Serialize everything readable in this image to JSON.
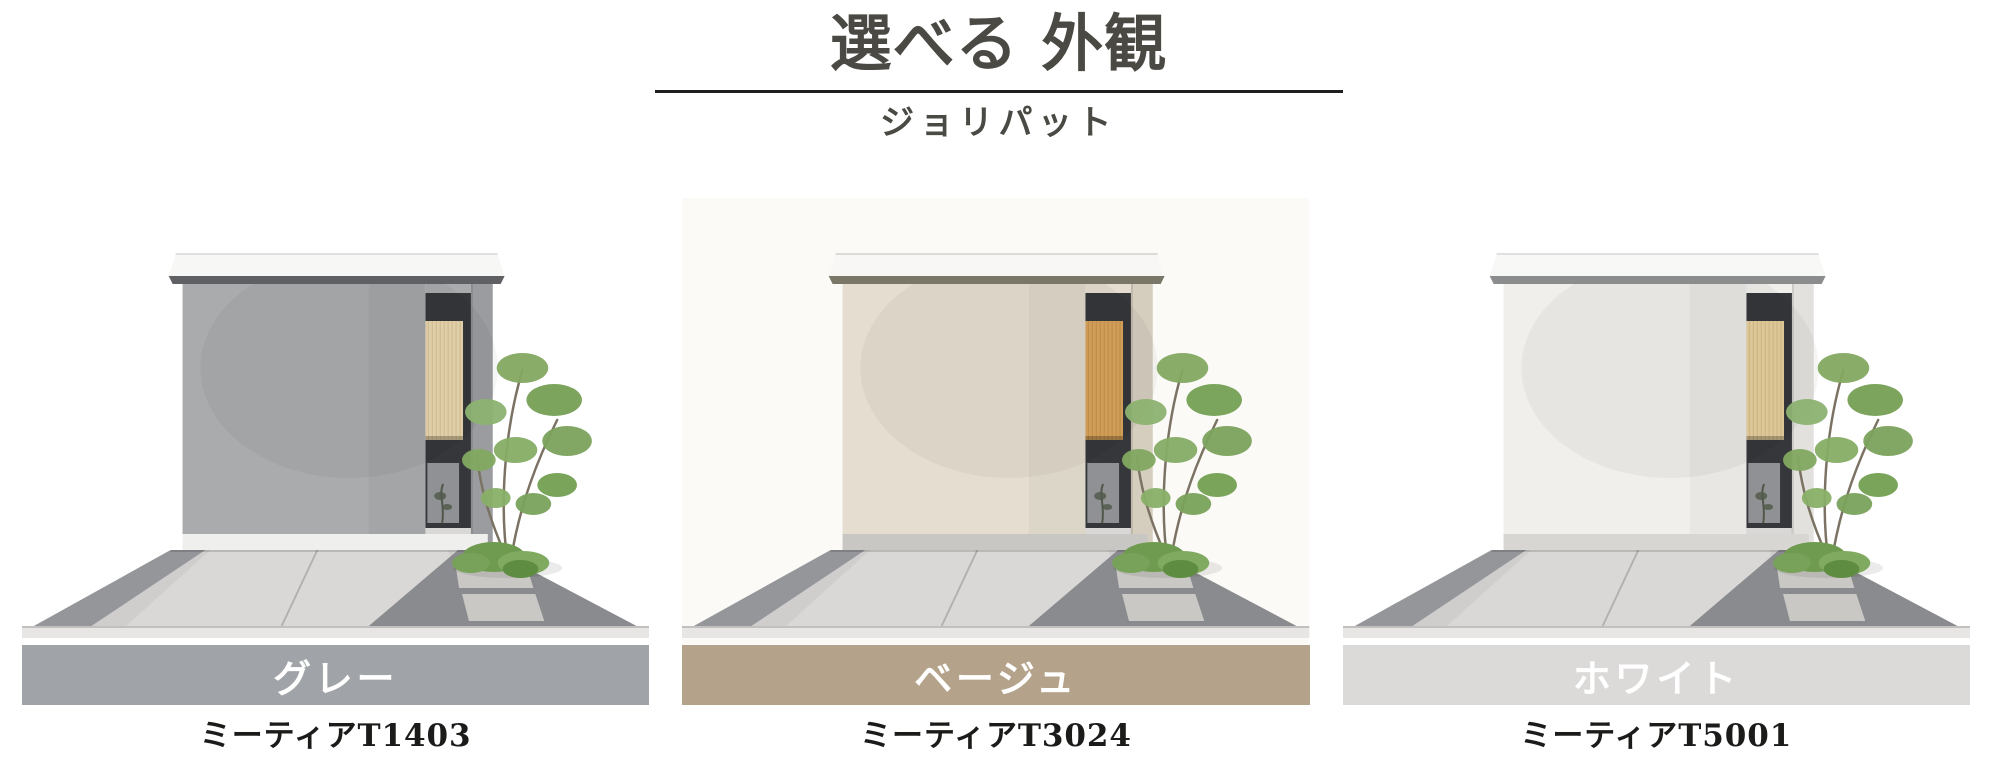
{
  "header": {
    "title": "選べる 外観",
    "subtitle": "ジョリパット"
  },
  "theme": {
    "background": "#ffffff",
    "title_color": "#4a4943",
    "divider_color": "#1f1f1f",
    "product_text_color": "#1b1b19",
    "swatch_text_color": "#ffffff"
  },
  "options": [
    {
      "name": "グレー",
      "product_code": "ミーティアT1403",
      "swatch_color": "#a0a3a7",
      "house": {
        "facade": "#a9abad",
        "pillar": "#9a9c9f",
        "roof": "#f7f7f6",
        "roof_shadow": "#5e6063",
        "wood": "#e9d7ae",
        "wood_line": "#c8ae7e",
        "base": "#efefed",
        "photo_bg": "#ffffff"
      }
    },
    {
      "name": "ベージュ",
      "product_code": "ミーティアT3024",
      "swatch_color": "#b4a28a",
      "house": {
        "facade": "#e4ddd0",
        "pillar": "#d5cdbe",
        "roof": "#f8f7f5",
        "roof_shadow": "#7a7668",
        "wood": "#d9a55c",
        "wood_line": "#b17f39",
        "base": "#c8c7c3",
        "photo_bg": "#fbfaf7"
      }
    },
    {
      "name": "ホワイト",
      "product_code": "ミーティアT5001",
      "swatch_color": "#dcdad8",
      "house": {
        "facade": "#f0efec",
        "pillar": "#e2e1dd",
        "roof": "#f8f8f7",
        "roof_shadow": "#8b8c8e",
        "wood": "#e7d0a0",
        "wood_line": "#c4a76e",
        "base": "#d7d6d3",
        "photo_bg": "#ffffff"
      }
    }
  ]
}
